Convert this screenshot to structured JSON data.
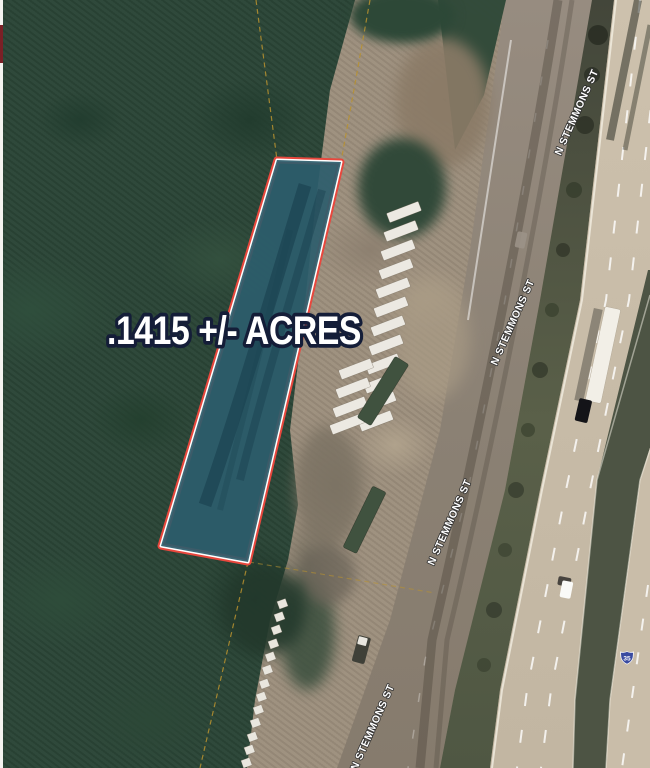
{
  "map_overlay": {
    "acreage_label": ".1415 +/- ACRES"
  },
  "street_labels": [
    {
      "label": "N STEMMONS ST"
    },
    {
      "label": "N STEMMONS ST"
    },
    {
      "label": "N STEMMONS ST"
    },
    {
      "label": "N STEMMONS ST"
    }
  ],
  "highway_shield": {
    "route_number": "35"
  },
  "colors": {
    "parcel_outline": "#e8473d",
    "parcel_inner_stroke": "#ffffff",
    "parcel_fill": "#2d5d6d",
    "acreage_text_fill": "#ffffff",
    "acreage_text_outline": "#141d38",
    "survey_line": "#b8922f",
    "vegetation": "#2a4536",
    "dirt": "#9c8e7c",
    "frontage_road": "#8b8174",
    "highway": "#c6baa6"
  }
}
